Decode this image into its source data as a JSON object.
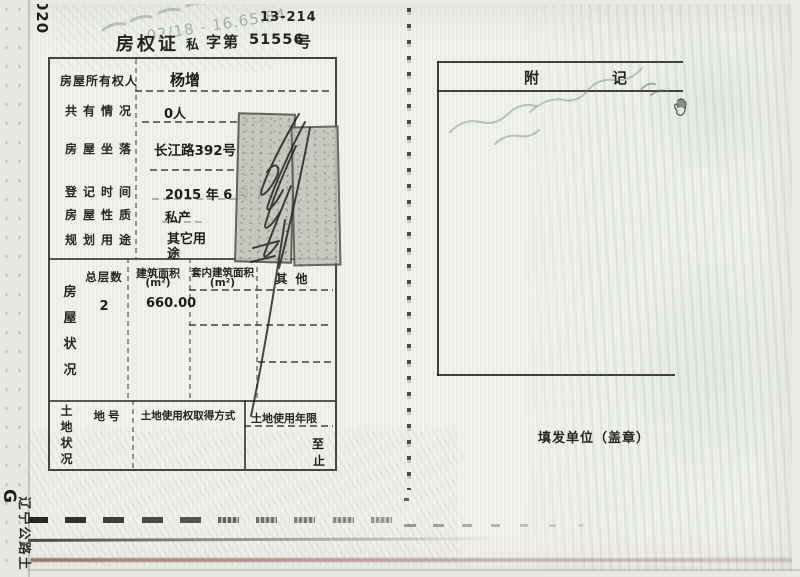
{
  "header": {
    "spine_number": "020",
    "form_code": "13-214",
    "watermark": "02/18 - 16.65.84",
    "cert_title": "房权证",
    "cert_type": "私",
    "zi_di": "字第",
    "cert_number": "51556",
    "hao": "号"
  },
  "owner_table": {
    "rows": [
      {
        "label": "房屋所有权人",
        "value": "杨增"
      },
      {
        "label": "共有情况",
        "value": "0人"
      },
      {
        "label": "房屋坐落",
        "value": "长江路392号"
      },
      {
        "label": "登记时间",
        "value": "2015 年 6 月 1"
      },
      {
        "label": "房屋性质",
        "value": "私产"
      },
      {
        "label": "规划用途",
        "value": "其它用途"
      }
    ]
  },
  "house_status": {
    "side_label": "房屋状况",
    "col_floors": "总层数",
    "col_area": "建筑面积",
    "col_area_unit": "(m²)",
    "col_inner": "套内建筑面积",
    "col_inner_unit": "(m²)",
    "col_other": "其他",
    "floors_value": "2",
    "area_value": "660.00"
  },
  "land_status": {
    "side_label": "土地状况",
    "col_parcel": "地号",
    "col_method": "土地使用权取得方式",
    "col_term": "土地使用年限",
    "term_from": "至",
    "term_to": "止"
  },
  "remarks": {
    "title_left": "附",
    "title_right": "记"
  },
  "issuer": {
    "label": "填发单位（盖章）"
  },
  "edge_marks": {
    "bottom_left_g": "G",
    "bottom_left_text": "辽宁公路土"
  }
}
